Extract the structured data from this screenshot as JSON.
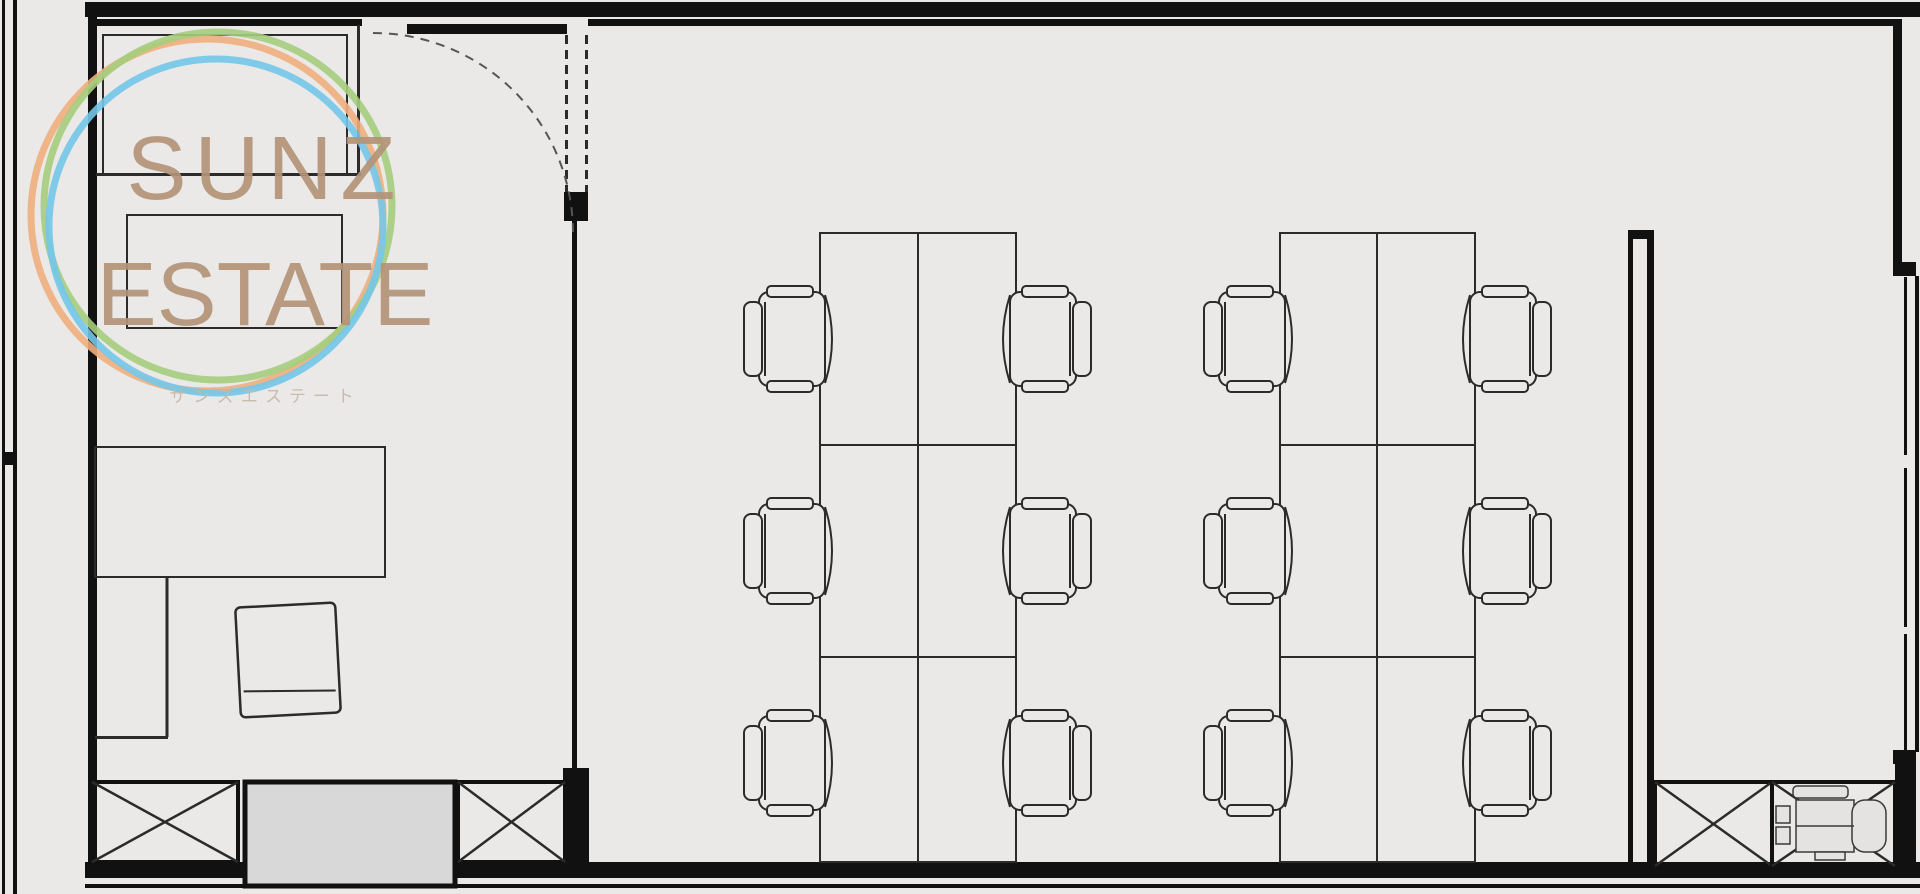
{
  "watermark": {
    "line1": "SUNZ",
    "line2": "ESTATE",
    "subtitle": "サンズエステート",
    "text_color": "#b39478",
    "subtitle_color": "#c9b9a8",
    "rings": [
      {
        "name": "ring-orange",
        "color": "#f0ae7c",
        "cx": 207,
        "cy": 215,
        "r": 176
      },
      {
        "name": "ring-green",
        "color": "#a5cd7c",
        "cx": 218,
        "cy": 206,
        "r": 174
      },
      {
        "name": "ring-blue",
        "color": "#74c6e9",
        "cx": 216,
        "cy": 226,
        "r": 167
      }
    ],
    "ring_stroke_width": 7
  },
  "floorplan": {
    "colors": {
      "bg": "#eae9e7",
      "wall": "#111111",
      "line": "#2b2b2b",
      "thin": "#3a3a3a",
      "gray_fill": "#d8d8d8",
      "fixture_fill": "#e4e3e1",
      "arc": "#555555"
    },
    "bars": [
      {
        "name": "outer-left-line-1",
        "x": 2,
        "y": 0,
        "w": 3,
        "h": 894
      },
      {
        "name": "outer-left-line-2",
        "x": 13,
        "y": 0,
        "w": 4,
        "h": 894
      },
      {
        "name": "outer-left-tick",
        "x": 3,
        "y": 452,
        "w": 14,
        "h": 13
      },
      {
        "name": "wall-top-outer",
        "x": 85,
        "y": 2,
        "w": 1835,
        "h": 15
      },
      {
        "name": "wall-top-inner-left",
        "x": 96,
        "y": 19,
        "w": 266,
        "h": 7
      },
      {
        "name": "wall-top-inner-right",
        "x": 588,
        "y": 19,
        "w": 1306,
        "h": 7
      },
      {
        "name": "wall-left",
        "x": 88,
        "y": 2,
        "w": 9,
        "h": 876
      },
      {
        "name": "wall-bottom",
        "x": 85,
        "y": 862,
        "w": 1835,
        "h": 16
      },
      {
        "name": "wall-bottom-outer-line",
        "x": 85,
        "y": 884,
        "w": 1835,
        "h": 4
      },
      {
        "name": "entrance-door-leaf",
        "x": 407,
        "y": 24,
        "w": 160,
        "h": 10
      },
      {
        "name": "entrance-glass-post",
        "x": 564,
        "y": 192,
        "w": 24,
        "h": 29
      },
      {
        "name": "partition-wall-line",
        "x": 572,
        "y": 221,
        "w": 5,
        "h": 547
      },
      {
        "name": "partition-bottom-post",
        "x": 563,
        "y": 768,
        "w": 26,
        "h": 106
      },
      {
        "name": "wall-right-upper",
        "x": 1893,
        "y": 19,
        "w": 9,
        "h": 247
      },
      {
        "name": "wall-right-cap-upper",
        "x": 1893,
        "y": 262,
        "w": 23,
        "h": 14
      },
      {
        "name": "window-right-inner-seg1",
        "x": 1904,
        "y": 277,
        "w": 3,
        "h": 178
      },
      {
        "name": "window-right-inner-seg2",
        "x": 1904,
        "y": 468,
        "w": 3,
        "h": 159
      },
      {
        "name": "window-right-inner-seg3",
        "x": 1904,
        "y": 634,
        "w": 3,
        "h": 116
      },
      {
        "name": "window-right-outer-line",
        "x": 1915,
        "y": 276,
        "w": 4,
        "h": 476
      },
      {
        "name": "wall-right-cap-lower",
        "x": 1893,
        "y": 750,
        "w": 23,
        "h": 14
      },
      {
        "name": "wall-right-lower",
        "x": 1895,
        "y": 764,
        "w": 21,
        "h": 112
      },
      {
        "name": "partition2-left-line",
        "x": 1628,
        "y": 230,
        "w": 5,
        "h": 632
      },
      {
        "name": "partition2-right-line",
        "x": 1647,
        "y": 230,
        "w": 7,
        "h": 632
      },
      {
        "name": "partition2-top-cap",
        "x": 1628,
        "y": 230,
        "w": 26,
        "h": 9
      }
    ],
    "outlines": [
      {
        "name": "reception-cabinet",
        "x": 103,
        "y": 35,
        "w": 244,
        "h": 139,
        "sw": 2
      },
      {
        "name": "reception-table",
        "x": 127,
        "y": 215,
        "w": 215,
        "h": 113,
        "sw": 2
      },
      {
        "name": "manager-desk",
        "x": 95,
        "y": 447,
        "w": 290,
        "h": 130,
        "sw": 2
      }
    ],
    "lines": [
      {
        "name": "wall-stub",
        "x1": 358.5,
        "y1": 25,
        "x2": 358.5,
        "y2": 176,
        "w": 3
      },
      {
        "name": "cabinet-bottom-line",
        "x1": 96,
        "y1": 174.5,
        "x2": 361,
        "y2": 174.5,
        "w": 3
      },
      {
        "name": "low-cabinet-side",
        "x1": 167,
        "y1": 577,
        "x2": 167,
        "y2": 737,
        "w": 3
      },
      {
        "name": "low-cabinet-bottom",
        "x1": 95,
        "y1": 737.5,
        "x2": 168,
        "y2": 737.5,
        "w": 3
      },
      {
        "name": "entrance-glass-dash-1",
        "x1": 566.5,
        "y1": 35,
        "x2": 566.5,
        "y2": 192,
        "w": 3,
        "dash": "9 6"
      },
      {
        "name": "entrance-glass-dash-2",
        "x1": 586.5,
        "y1": 35,
        "x2": 586.5,
        "y2": 192,
        "w": 3,
        "dash": "9 6"
      }
    ],
    "door_arc": {
      "name": "entrance-door-swing-arc",
      "d": "M 373 33 A 200 200 0 0 1 573 233",
      "dash": "9 7",
      "w": 2
    },
    "desk_islands": [
      {
        "name": "desk-island-left",
        "x": 820,
        "y": 233,
        "w": 196,
        "h": 629,
        "divider_x": 918,
        "row_lines_y": [
          445,
          657
        ]
      },
      {
        "name": "desk-island-right",
        "x": 1280,
        "y": 233,
        "w": 195,
        "h": 629,
        "divider_x": 1377,
        "row_lines_y": [
          445,
          657
        ]
      }
    ],
    "chairs": [
      {
        "cx": 791,
        "cy": 339,
        "facing": "right"
      },
      {
        "cx": 791,
        "cy": 551,
        "facing": "right"
      },
      {
        "cx": 791,
        "cy": 763,
        "facing": "right"
      },
      {
        "cx": 1044,
        "cy": 339,
        "facing": "left"
      },
      {
        "cx": 1044,
        "cy": 551,
        "facing": "left"
      },
      {
        "cx": 1044,
        "cy": 763,
        "facing": "left"
      },
      {
        "cx": 1251,
        "cy": 339,
        "facing": "right"
      },
      {
        "cx": 1251,
        "cy": 551,
        "facing": "right"
      },
      {
        "cx": 1251,
        "cy": 763,
        "facing": "right"
      },
      {
        "cx": 1504,
        "cy": 339,
        "facing": "left"
      },
      {
        "cx": 1504,
        "cy": 551,
        "facing": "left"
      },
      {
        "cx": 1504,
        "cy": 763,
        "facing": "left"
      }
    ],
    "exec_chair": {
      "name": "manager-chair",
      "cx": 288,
      "cy": 660,
      "w": 100,
      "h": 110,
      "angle": -3
    },
    "hatch_boxes": [
      {
        "name": "balcony-hatch-left-1",
        "x": 92,
        "y": 782,
        "w": 146,
        "h": 80,
        "sw": 4
      },
      {
        "name": "balcony-hatch-left-2",
        "x": 458,
        "y": 782,
        "w": 107,
        "h": 80,
        "sw": 4
      },
      {
        "name": "balcony-hatch-right-1",
        "x": 1655,
        "y": 782,
        "w": 117,
        "h": 84,
        "sw": 4
      },
      {
        "name": "balcony-hatch-right-2",
        "x": 1772,
        "y": 782,
        "w": 123,
        "h": 84,
        "sw": 4
      }
    ],
    "gray_box": {
      "name": "elevator-gray-box",
      "x": 245,
      "y": 782,
      "w": 210,
      "h": 104,
      "sw": 5
    },
    "fixture_shapes": [
      {
        "t": "rrect",
        "x": 1793,
        "y": 786,
        "w": 55,
        "h": 12,
        "rx": 4
      },
      {
        "t": "rect",
        "x": 1796,
        "y": 800,
        "w": 58,
        "h": 52
      },
      {
        "t": "rect",
        "x": 1776,
        "y": 806,
        "w": 14,
        "h": 17
      },
      {
        "t": "rect",
        "x": 1776,
        "y": 827,
        "w": 14,
        "h": 17
      },
      {
        "t": "rrect",
        "x": 1852,
        "y": 800,
        "w": 34,
        "h": 52,
        "rx": 13
      },
      {
        "t": "rect",
        "x": 1815,
        "y": 852,
        "w": 30,
        "h": 8
      },
      {
        "t": "line",
        "x1": 1796,
        "y1": 826,
        "x2": 1854,
        "y2": 826
      }
    ]
  }
}
